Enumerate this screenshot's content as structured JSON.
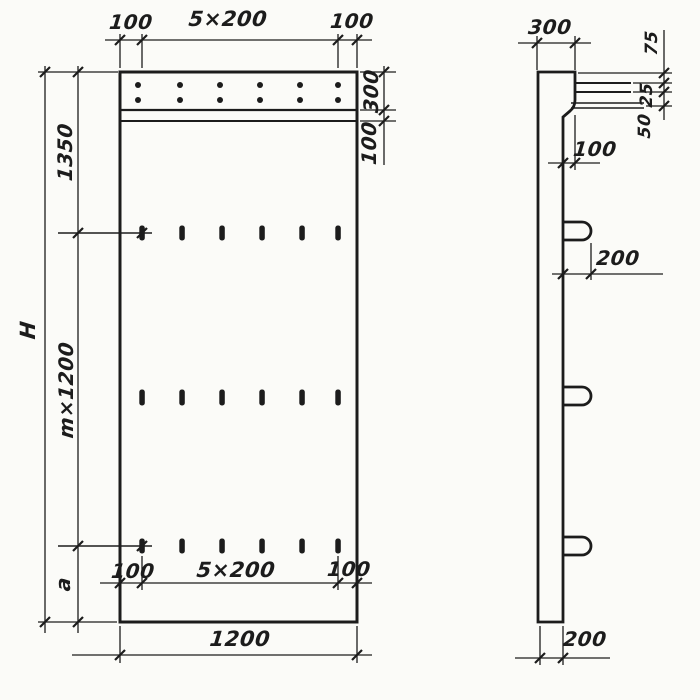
{
  "front_view": {
    "top_dim": {
      "left": "100",
      "middle": "5×200",
      "right": "100"
    },
    "slot_dim": {
      "left": "100",
      "middle": "5×200",
      "right": "100"
    },
    "overall_width": "1200",
    "height_total": "H",
    "height_top": "1350",
    "height_module": "m×1200",
    "height_bottom": "a",
    "cap_depth": "300",
    "cap_strip": "100"
  },
  "side_view": {
    "top_width": "300",
    "stack_top": "75",
    "stack_mid": "25",
    "stack_bottom": "50",
    "ledge": "100",
    "loop": "200",
    "thickness": "200"
  },
  "colors": {
    "ink": "#1c1c1c",
    "paper": "#fbfbf8"
  }
}
